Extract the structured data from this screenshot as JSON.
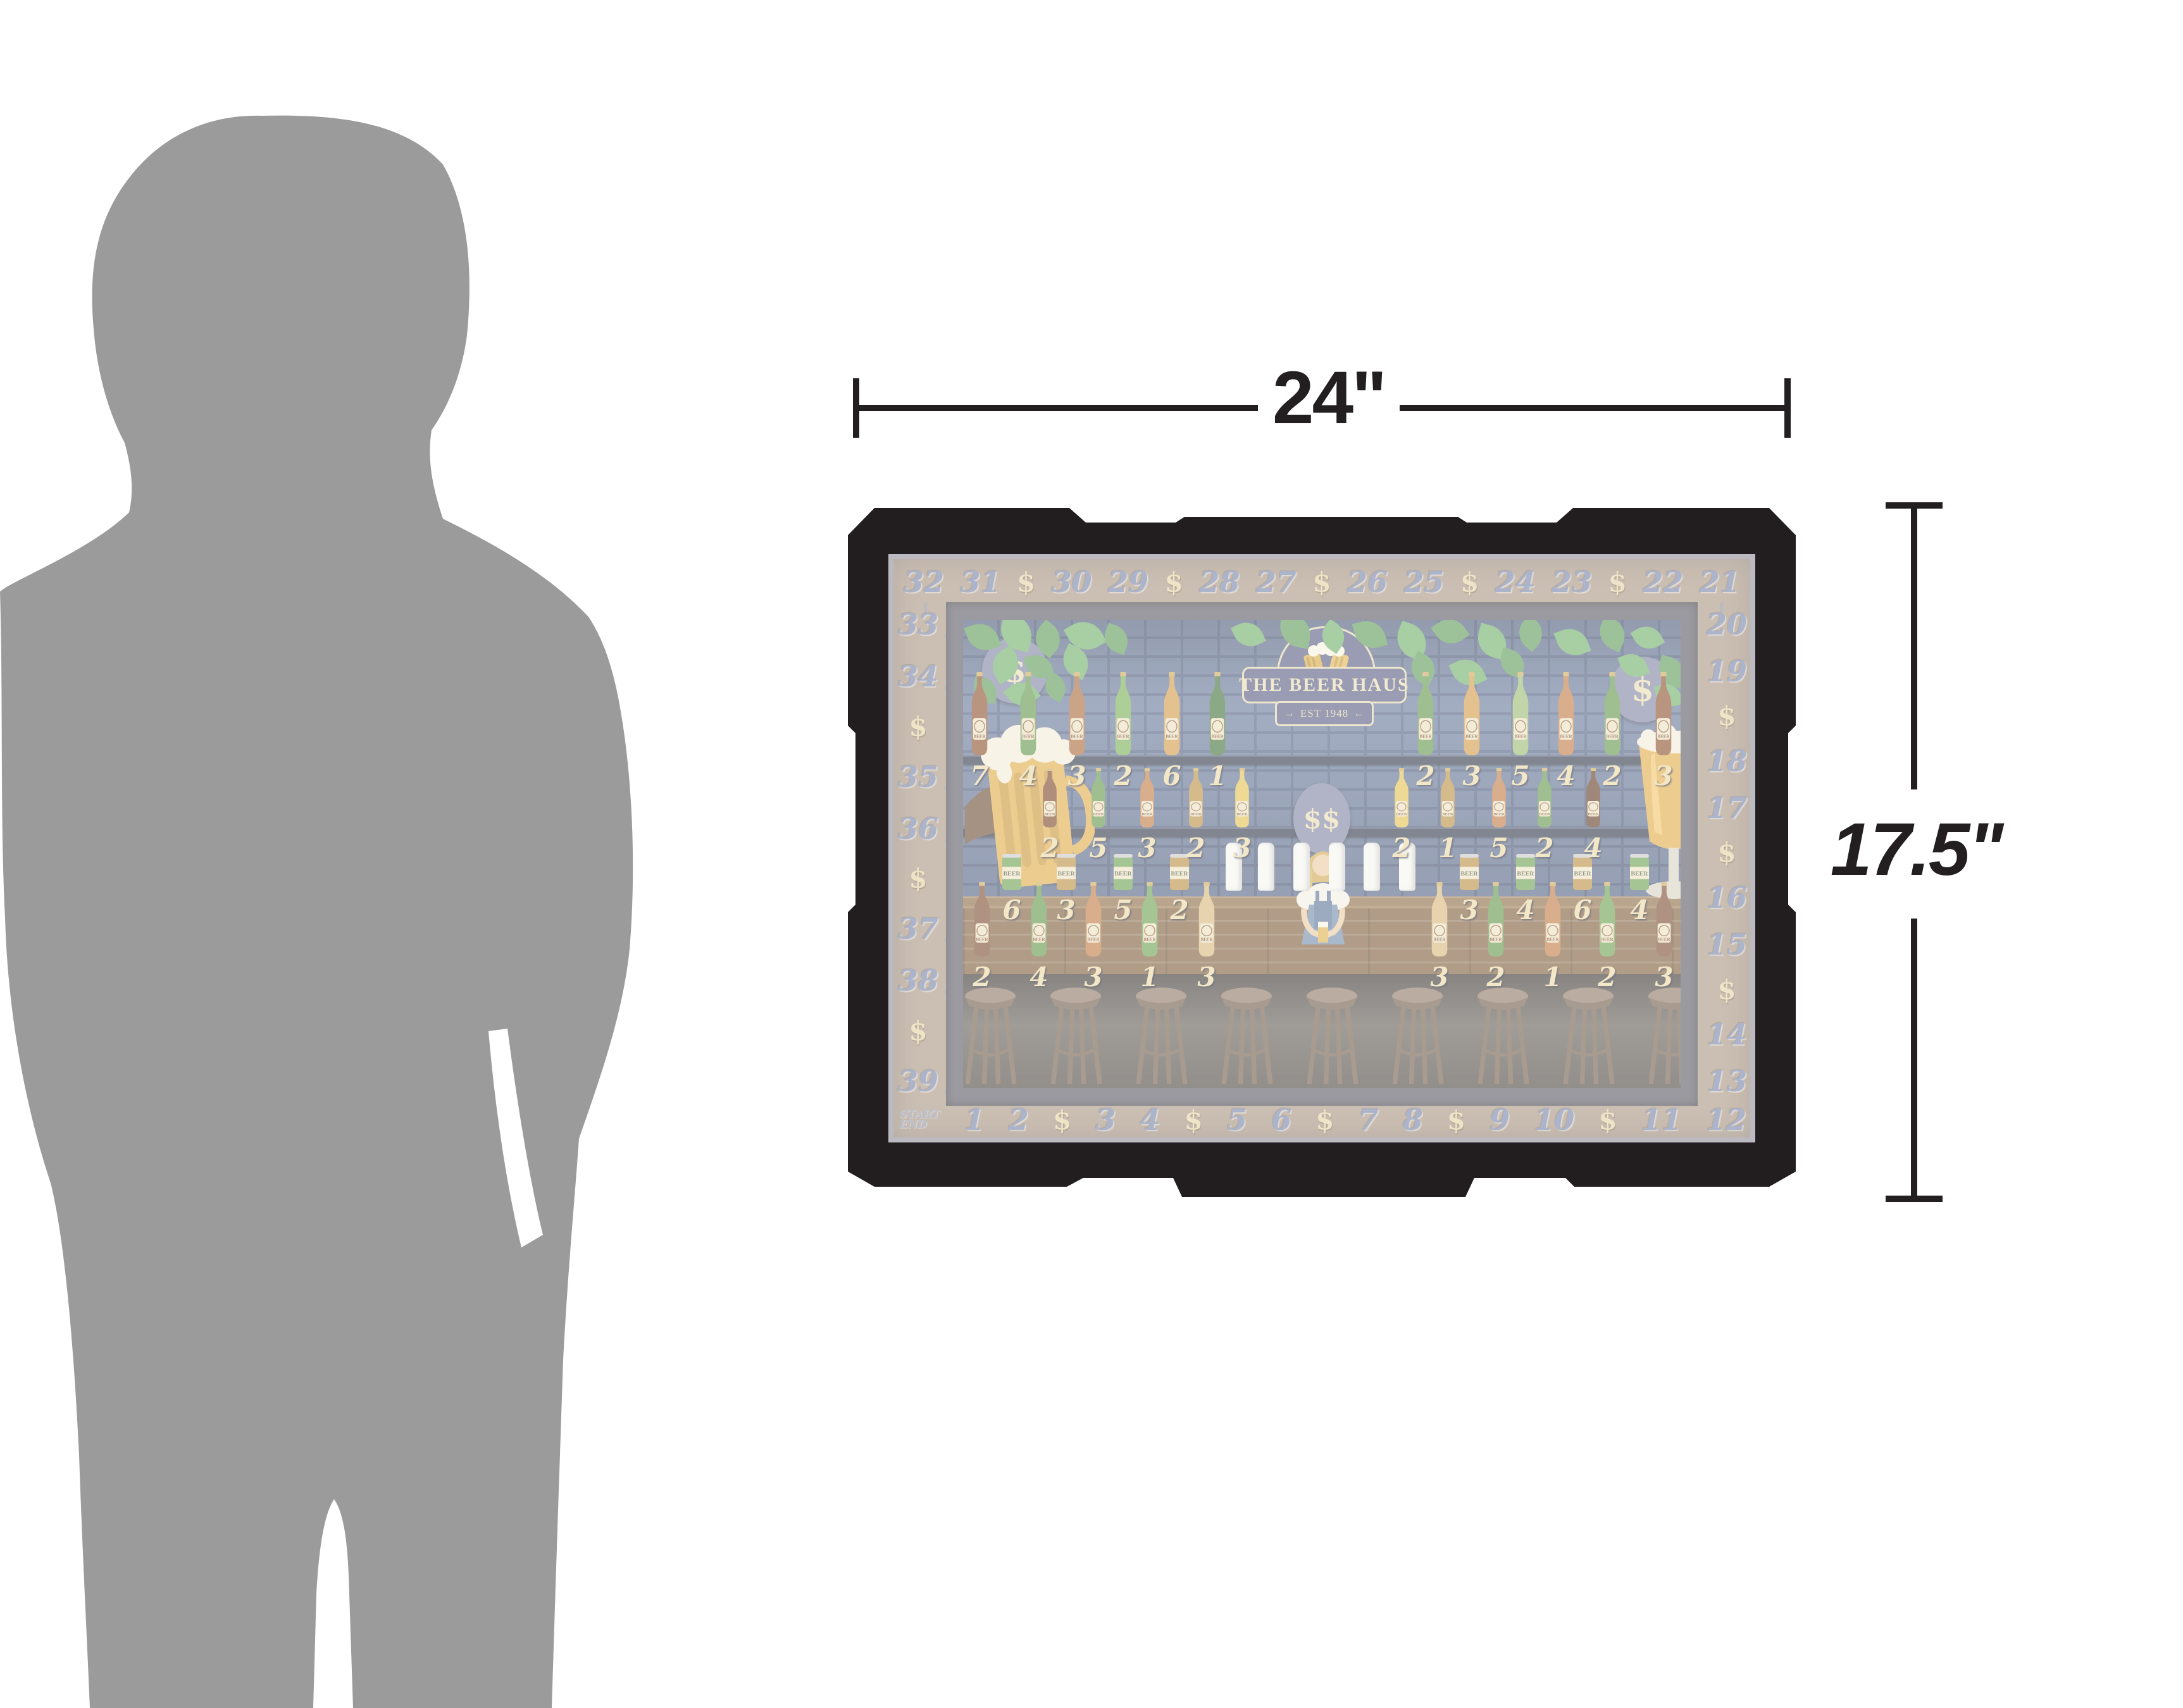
{
  "dimensions": {
    "width_label": "24\"",
    "height_label": "17.5\""
  },
  "icons": {
    "scale_figure": "person-silhouette",
    "medallion": "dollar-sign",
    "product": "beer-haus-drinking-game-board"
  },
  "board": {
    "sign": {
      "title": "THE BEER HAUS",
      "established": "EST 1948",
      "arrow_left": "→",
      "arrow_right": "←",
      "crown": "♕"
    },
    "medallions": {
      "left": "$",
      "right": "$",
      "center": "$$"
    },
    "bottle_label": "BEER",
    "track": {
      "top": [
        "32",
        "31",
        "$",
        "30",
        "29",
        "$",
        "28",
        "27",
        "$",
        "26",
        "25",
        "$",
        "24",
        "23",
        "$",
        "22",
        "21"
      ],
      "right": [
        "20",
        "19",
        "$",
        "18",
        "17",
        "$",
        "16",
        "15",
        "$",
        "14",
        "13"
      ],
      "bottom_start": [
        "START",
        "END"
      ],
      "bottom": [
        "1",
        "2",
        "$",
        "3",
        "4",
        "$",
        "5",
        "6",
        "$",
        "7",
        "8",
        "$",
        "9",
        "10",
        "$",
        "11",
        "12"
      ],
      "left": [
        "33",
        "34",
        "$",
        "35",
        "36",
        "$",
        "37",
        "38",
        "$",
        "39"
      ]
    },
    "shelves": [
      {
        "name": "top-shelf",
        "type": "bottle",
        "items": [
          {
            "n": "7",
            "c": "#8a4f2a"
          },
          {
            "n": "4",
            "c": "#5f9447"
          },
          {
            "n": "3",
            "c": "#a8683a"
          },
          {
            "n": "2",
            "c": "#79ad52"
          },
          {
            "n": "6",
            "c": "#d29a45"
          },
          {
            "n": "1",
            "c": "#3f7038"
          },
          {
            "n": "2",
            "c": "#5f9447"
          },
          {
            "n": "3",
            "c": "#d29a45"
          },
          {
            "n": "5",
            "c": "#9aba6e"
          },
          {
            "n": "4",
            "c": "#c07840"
          },
          {
            "n": "2",
            "c": "#5f9447"
          },
          {
            "n": "3",
            "c": "#8a4f2a"
          }
        ]
      },
      {
        "name": "middle-shelf",
        "type": "bottle",
        "items": [
          {
            "n": "2",
            "c": "#7a4526"
          },
          {
            "n": "5",
            "c": "#5f9447"
          },
          {
            "n": "3",
            "c": "#c07840"
          },
          {
            "n": "2",
            "c": "#b98e3e"
          },
          {
            "n": "3",
            "c": "#e3c04f"
          },
          {
            "n": "2",
            "c": "#e3c04f"
          },
          {
            "n": "1",
            "c": "#b98e3e"
          },
          {
            "n": "5",
            "c": "#c07840"
          },
          {
            "n": "2",
            "c": "#5f9447"
          },
          {
            "n": "4",
            "c": "#5f3a22"
          }
        ]
      },
      {
        "name": "can-shelf",
        "type": "can",
        "items": [
          {
            "n": "6",
            "c": "#6aa04e"
          },
          {
            "n": "3",
            "c": "#b98e3e"
          },
          {
            "n": "5",
            "c": "#6aa04e"
          },
          {
            "n": "2",
            "c": "#b98e3e"
          },
          {
            "n": "3",
            "c": "#b98e3e"
          },
          {
            "n": "4",
            "c": "#6aa04e"
          },
          {
            "n": "6",
            "c": "#b98e3e"
          },
          {
            "n": "4",
            "c": "#6aa04e"
          }
        ]
      },
      {
        "name": "bar-counter",
        "type": "bottle",
        "items": [
          {
            "n": "2",
            "c": "#7a4a2e"
          },
          {
            "n": "4",
            "c": "#5f9447"
          },
          {
            "n": "3",
            "c": "#c07840"
          },
          {
            "n": "1",
            "c": "#6aa04e"
          },
          {
            "n": "3",
            "c": "#d8b87a"
          },
          {
            "n": "3",
            "c": "#d8b87a"
          },
          {
            "n": "2",
            "c": "#5f9447"
          },
          {
            "n": "1",
            "c": "#c07840"
          },
          {
            "n": "2",
            "c": "#6aa04e"
          },
          {
            "n": "3",
            "c": "#7a4a2e"
          }
        ]
      }
    ],
    "stool_count": 9,
    "glass_count": 6,
    "colors": {
      "frame": "#221e1f",
      "border_tan": "#a8937f",
      "bezel": "#585862",
      "brick": "#5e7093",
      "track_number": "#7383a8",
      "track_cash": "#e3d2a2",
      "shelf_number": "#ead7a2",
      "silhouette": "#9b9b9b",
      "dimension": "#231f20"
    }
  }
}
